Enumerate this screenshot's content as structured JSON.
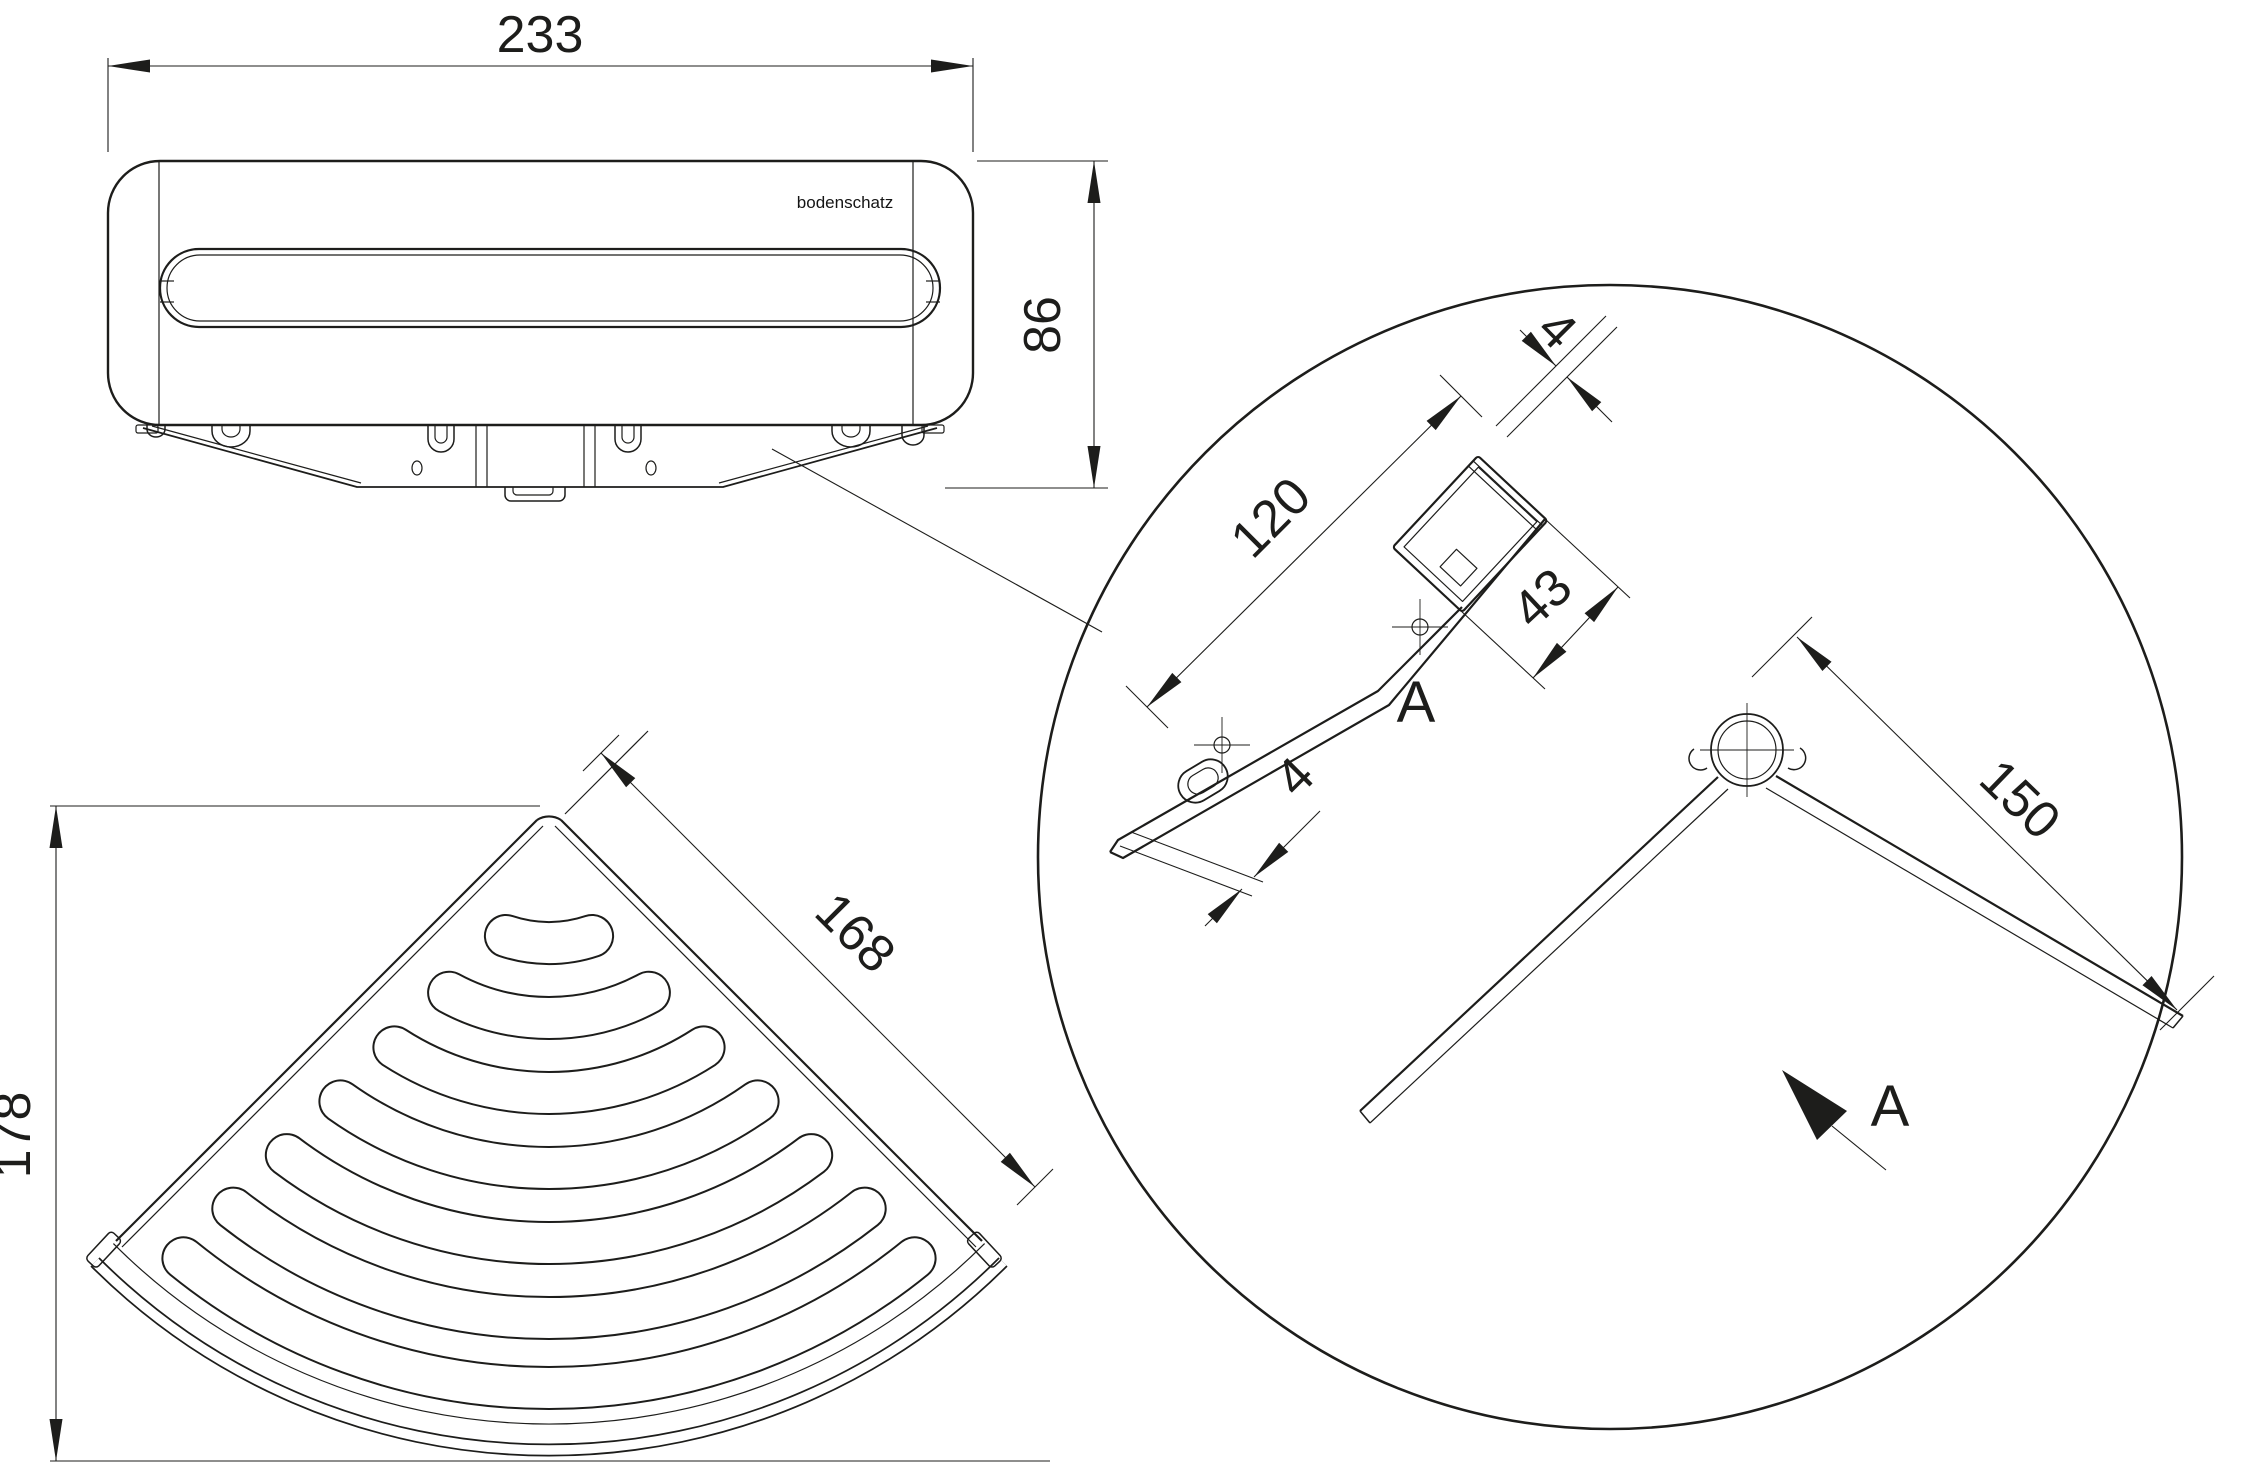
{
  "logo": "bodenschatz",
  "dims": {
    "front_width": "233",
    "front_height": "86",
    "plan_edge": "168",
    "plan_depth": "178",
    "rail_length": "120",
    "rail_cap_thickness": "4",
    "clip_section_width": "43",
    "rail_tip_thickness": "4",
    "arm_length": "150",
    "section_marker": "A",
    "section_arrow_label": "A"
  },
  "colors": {
    "line": "#1d1d1b",
    "background": "#ffffff"
  }
}
